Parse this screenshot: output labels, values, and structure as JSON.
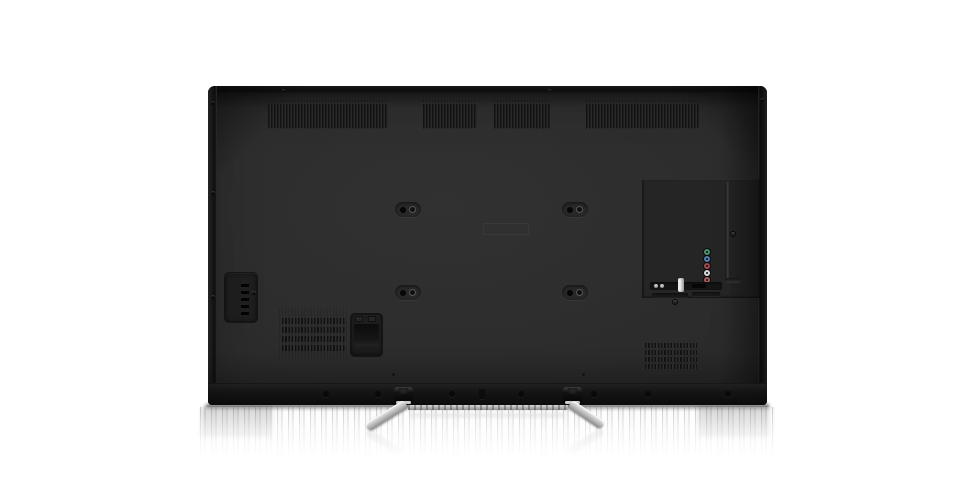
{
  "scene": {
    "type": "product-photo",
    "subject": "flat-screen television rear view on reflective white surface",
    "background_color": "#ffffff",
    "reflection_visible": true
  },
  "tv": {
    "body_color": "#2c2c2c",
    "edge_color": "#121212",
    "bottom_band_color": "#0d0d0d",
    "vent_slot_color": "#141414",
    "top_vent_groups": 4,
    "vesa_hole_pairs": 4,
    "top_screws": 2,
    "side_screws": 6,
    "bottom_screw_holes": 7,
    "bottom_pinholes": 2,
    "center_label_visible": true
  },
  "side_port_panel": {
    "slots": 6,
    "screws": 1
  },
  "ac_inlet": {
    "present": true,
    "tabs": 2
  },
  "speaker_grilles": {
    "count": 2,
    "rows_per_grille": 4
  },
  "connector_panel": {
    "screws": 2,
    "av_jacks": [
      {
        "name": "component-video-y",
        "color": "#49936c"
      },
      {
        "name": "component-video-pb",
        "color": "#4f7fb0"
      },
      {
        "name": "component-video-pr",
        "color": "#a34a4a"
      },
      {
        "name": "audio-left",
        "color": "#d9d9d9"
      },
      {
        "name": "audio-right",
        "color": "#a85f5f"
      }
    ],
    "usb_pin_color": "#c9c9c9",
    "usb_pins": 2,
    "antenna_jack_color": "#ececec",
    "port_slots": 1
  },
  "stand": {
    "feet": 2,
    "leg_color": "#c4c4c4",
    "bracket_color": "#1a1a1a",
    "crossbar_color": "#bfbfbf"
  }
}
